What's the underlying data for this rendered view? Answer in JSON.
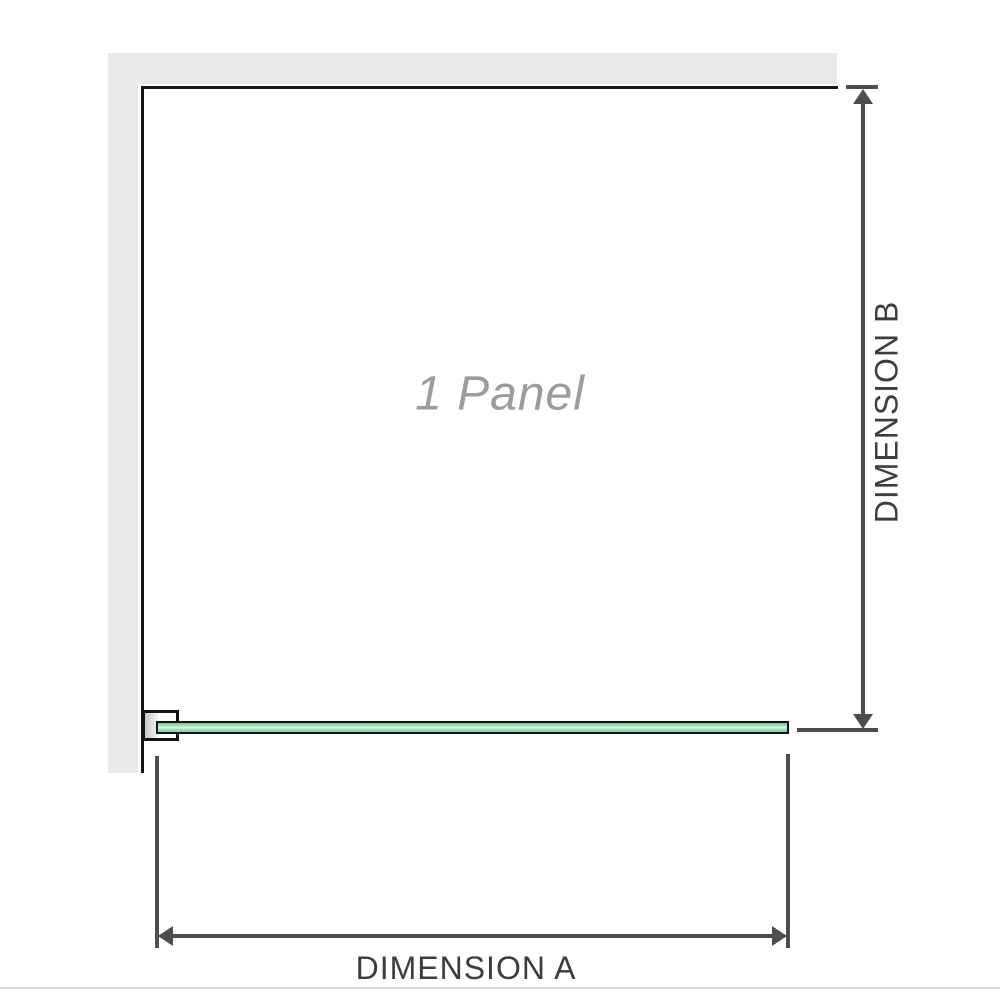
{
  "diagram": {
    "panel": {
      "label": "1 Panel",
      "count": 1
    },
    "dimension_a": {
      "label": "DIMENSION A",
      "axis": "width"
    },
    "dimension_b": {
      "label": "DIMENSION B",
      "axis": "height"
    },
    "colors": {
      "glass_green": "#8fd0a6",
      "glass_highlight": "#def2e7",
      "wall_gray": "#e9e9e9",
      "outline_black": "#161616",
      "dimension_line_gray": "#4d4d4d",
      "dimension_text_gray": "#3d3d3d",
      "panel_label_gray": "#9c9c9c",
      "divider_beige": "#dbd7d0"
    }
  }
}
